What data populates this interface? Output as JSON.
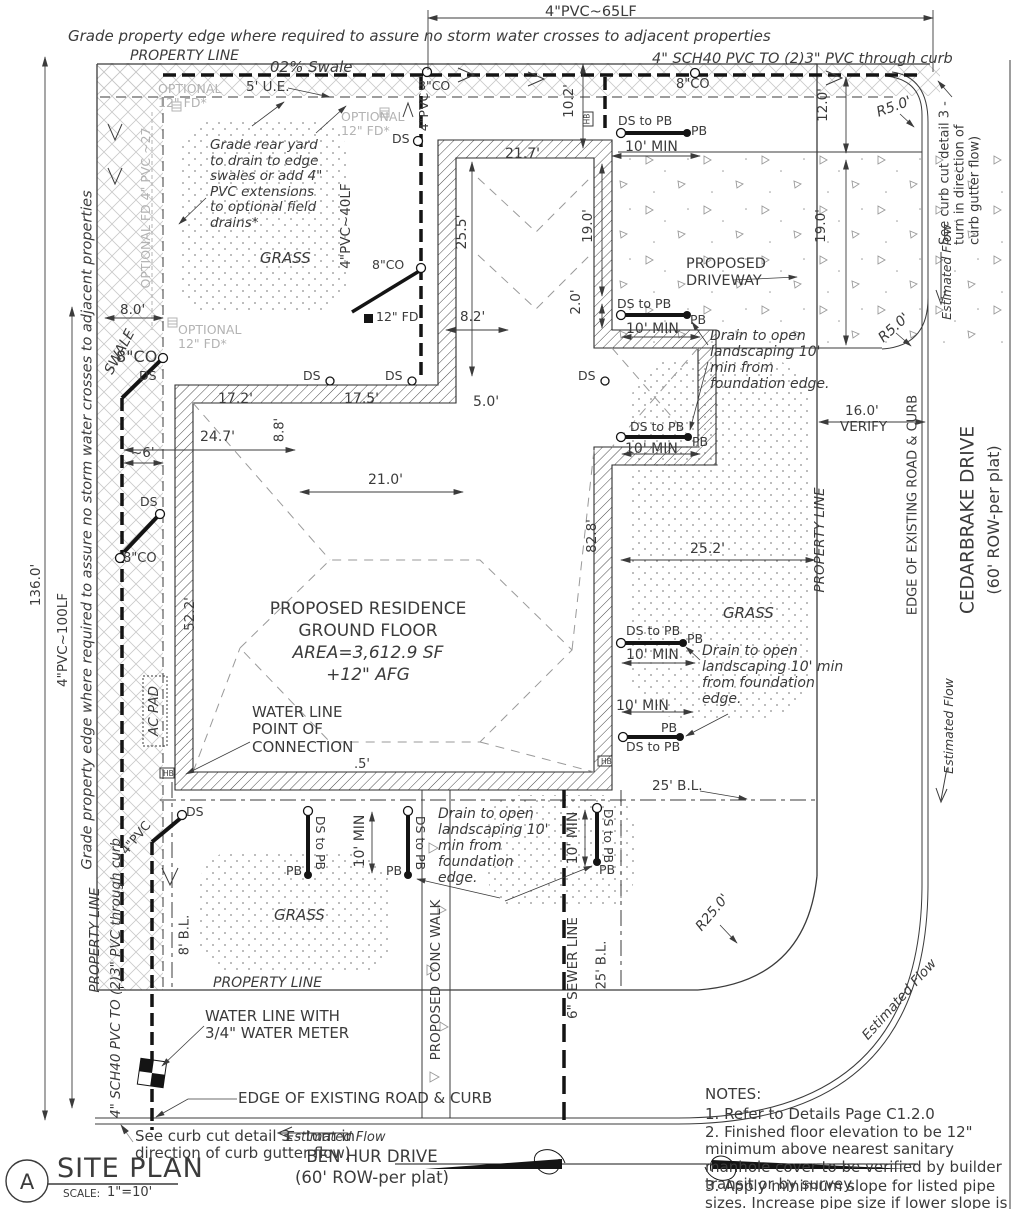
{
  "page": {
    "title": "SITE PLAN",
    "detail_letter": "A",
    "scale_label": "SCALE:",
    "scale_value": "1\"=10'"
  },
  "streets": {
    "ben_hur": "BEN HUR DRIVE",
    "cedarbrake": "CEDARBRAKE DRIVE",
    "row_note": "(60' ROW-per plat)"
  },
  "notes": {
    "heading": "NOTES:",
    "n1": "1. Refer to Details Page C1.2.0",
    "n2": "2. Finished floor elevation to be 12\" minimum above nearest sanitary manhole cover to be verified by builder transit or by survey.",
    "n3": "3. Apply minimum slope for listed pipe sizes. Increase pipe size if lower slope is required."
  },
  "residence": {
    "l1": "PROPOSED RESIDENCE",
    "l2": "GROUND FLOOR",
    "l3": "AREA=3,612.9 SF",
    "l4": "+12\" AFG"
  },
  "labels": {
    "property_line": "PROPERTY LINE",
    "grade_note": "Grade property edge where required  to assure no storm water crosses to adjacent properties",
    "swale_pct": "02% Swale",
    "ue5": "5' U.E.",
    "sch40": "4\" SCH40 PVC TO (2)3\" PVC through curb",
    "co8": "8\"CO",
    "fd12": "12\" FD",
    "optional_fd": "OPTIONAL\n12\" FD*",
    "optional_fd_line": "OPTIONAL FD 4\" PVC ~27",
    "grade_rear": "Grade rear yard to drain to edge swales or add 4\" PVC extensions to optional field drains*",
    "grass": "GRASS",
    "swale": "SWALE",
    "ds": "DS",
    "ds_to_pb": "DS to  PB",
    "pb": "PB",
    "hb": "HB",
    "drain_note": "Drain to open landscaping 10' min from foundation edge.",
    "proposed_driveway": "PROPOSED DRIVEWAY",
    "see_curb": "See curb cut detail 3 - turn in direction of curb gutter flow)",
    "est_flow": "Estimated Flow",
    "edge_road": "EDGE OF EXISTING ROAD & CURB",
    "sewer6": "6\" SEWER LINE",
    "conc_walk": "PROPOSED CONC WALK",
    "ac_pad": "AC PAD",
    "water_poc": "WATER LINE\nPOINT OF\nCONNECTION",
    "water_meter": "WATER LINE WITH\n3/4\" WATER METER",
    "pvc4": "4\"PVC"
  },
  "dims": {
    "pvc65": "4\"PVC~65LF",
    "pvc40": "4\"PVC~40LF",
    "pvc100": "4\"PVC~100LF",
    "d136": "136.0'",
    "d10_2": "10.2'",
    "d12_0": "12.0'",
    "d19_0": "19.0'",
    "d21_7": "21.7'",
    "d25_5": "25.5'",
    "d2_0": "2.0'",
    "d8_2": "8.2'",
    "d8_0": "8.0'",
    "d6": "~6'",
    "d17_2": "17.2'",
    "d17_5": "17.5'",
    "d24_7": "24.7'",
    "d8_8": "8.8'",
    "d21_0": "21.0'",
    "d5_0": "5.0'",
    "d52_2": "52.2'",
    "d82_8": "82.8'",
    "d25_2": "25.2'",
    "d16_0": "16.0'",
    "verify": "VERIFY",
    "r5": "R5.0'",
    "r25": "R25.0'",
    "min10": "10' MIN",
    "half": ".5'",
    "bl25": "25' B.L.",
    "bl8": "8' B.L."
  },
  "colors": {
    "line": "#3b3b3b",
    "pipe": "#141414",
    "muted": "#b3b3b3"
  }
}
